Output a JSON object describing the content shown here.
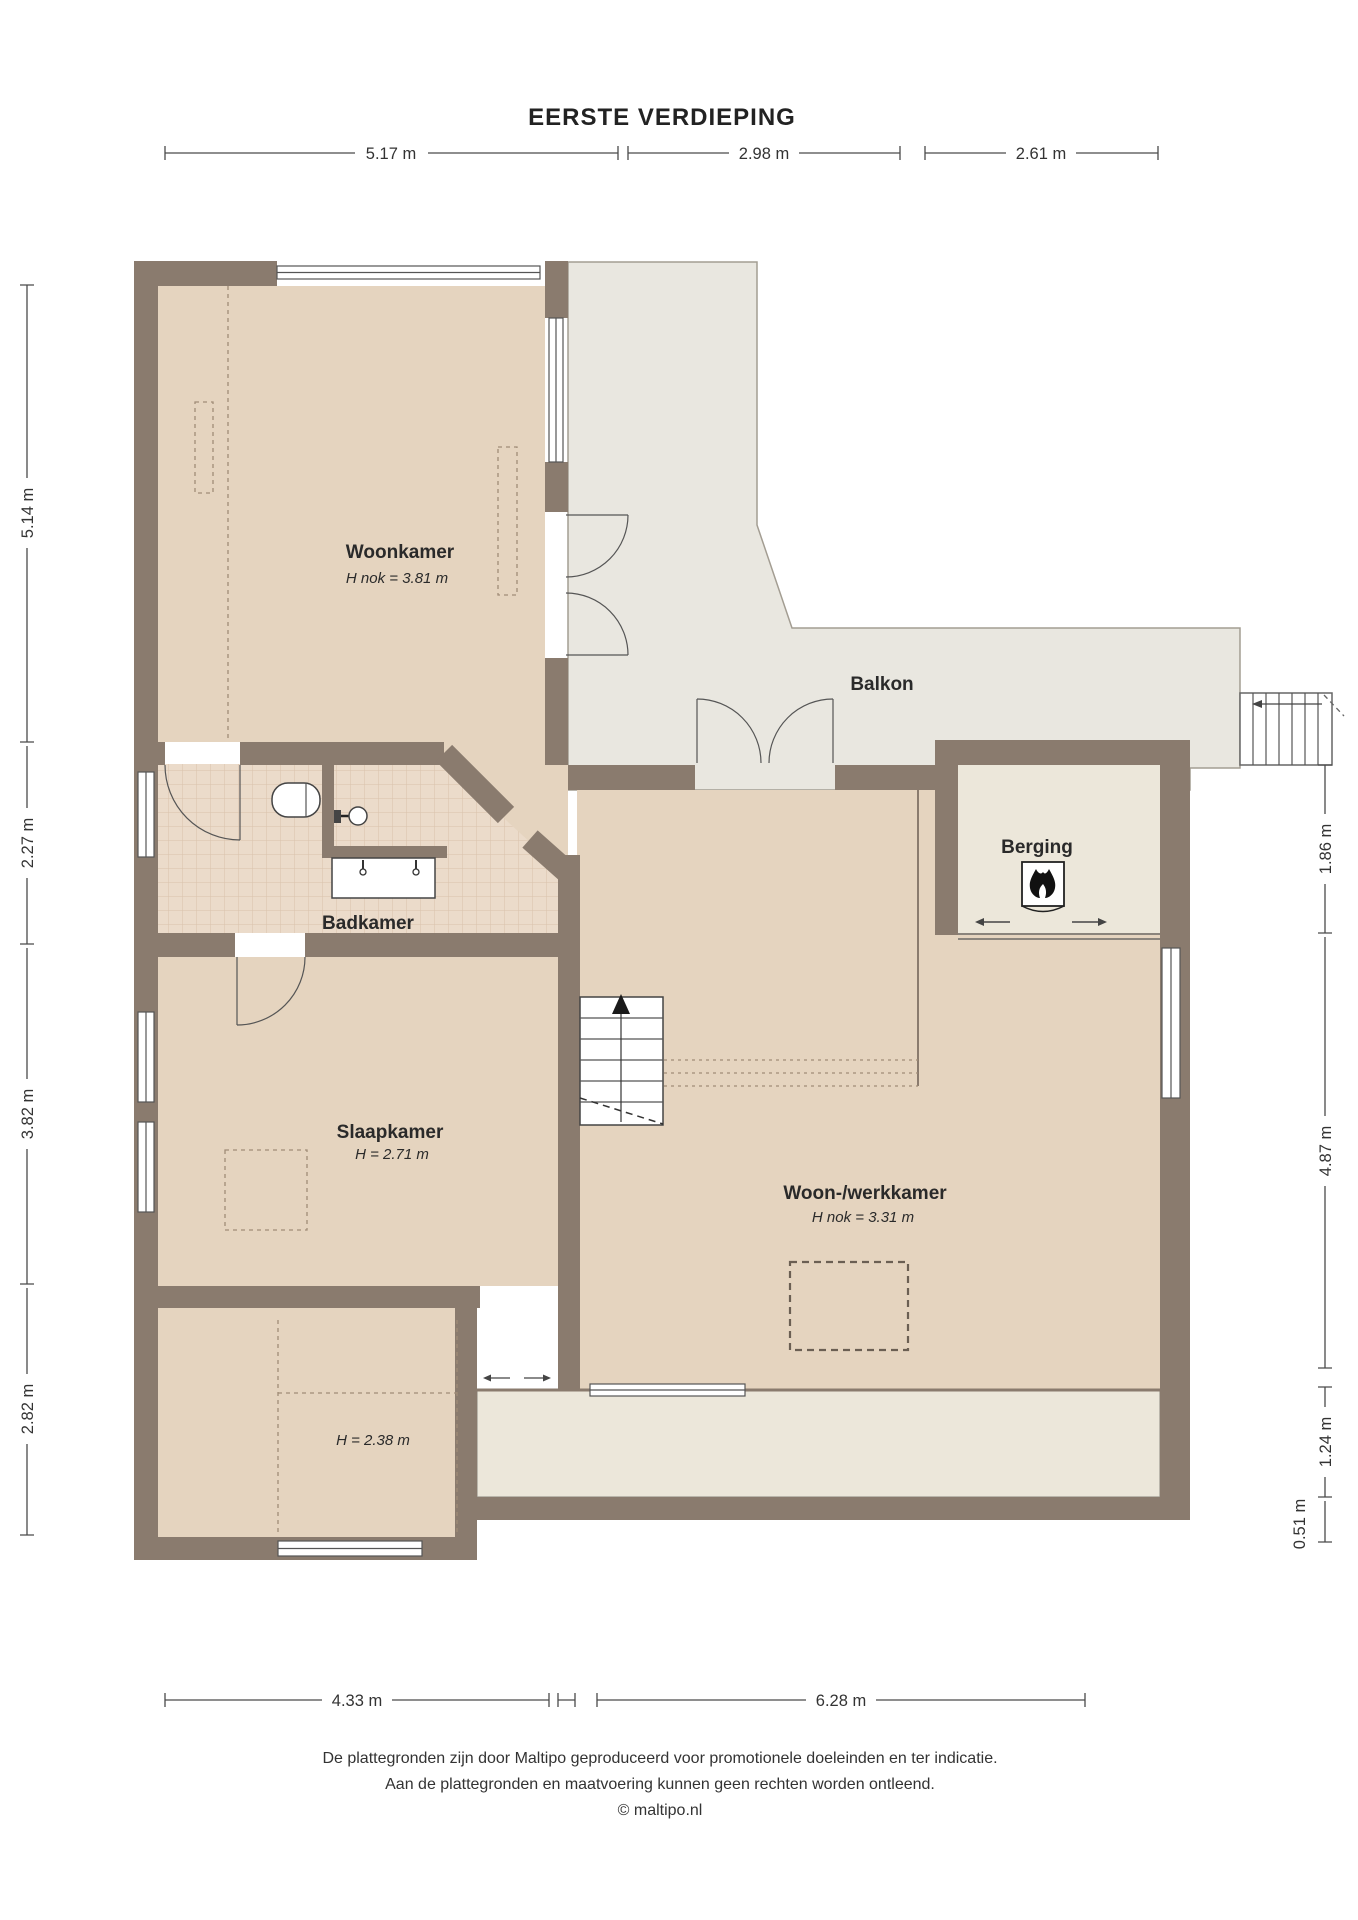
{
  "title": "EERSTE VERDIEPING",
  "rooms": {
    "woonkamer": {
      "name": "Woonkamer",
      "height_note": "H nok = 3.81 m"
    },
    "balkon": {
      "name": "Balkon"
    },
    "berging": {
      "name": "Berging"
    },
    "badkamer": {
      "name": "Badkamer"
    },
    "slaapkamer": {
      "name": "Slaapkamer",
      "height_note": "H = 2.71 m"
    },
    "woon_werkkamer": {
      "name": "Woon-/werkkamer",
      "height_note": "H nok = 3.31 m"
    },
    "kamer_238": {
      "height_note": "H = 2.38 m"
    }
  },
  "dimensions": {
    "top": [
      "5.17 m",
      "2.98 m",
      "2.61 m"
    ],
    "bottom": [
      "4.33 m",
      "6.28 m"
    ],
    "left": [
      "5.14 m",
      "2.27 m",
      "3.82 m",
      "2.82 m"
    ],
    "right": [
      "1.86 m",
      "4.87 m",
      "1.24 m",
      "0.51 m"
    ]
  },
  "footer": {
    "line1": "De plattegronden zijn door Maltipo geproduceerd voor promotionele doeleinden en ter indicatie.",
    "line2": "Aan de plattegronden en maatvoering kunnen geen rechten worden ontleend.",
    "line3": "© maltipo.nl"
  },
  "colors": {
    "wall": "#8a7b6e",
    "floor_main": "#e5d4bf",
    "floor_balcony": "#e9e7e0",
    "floor_light": "#ece7da",
    "tile": "#ebdbca"
  }
}
